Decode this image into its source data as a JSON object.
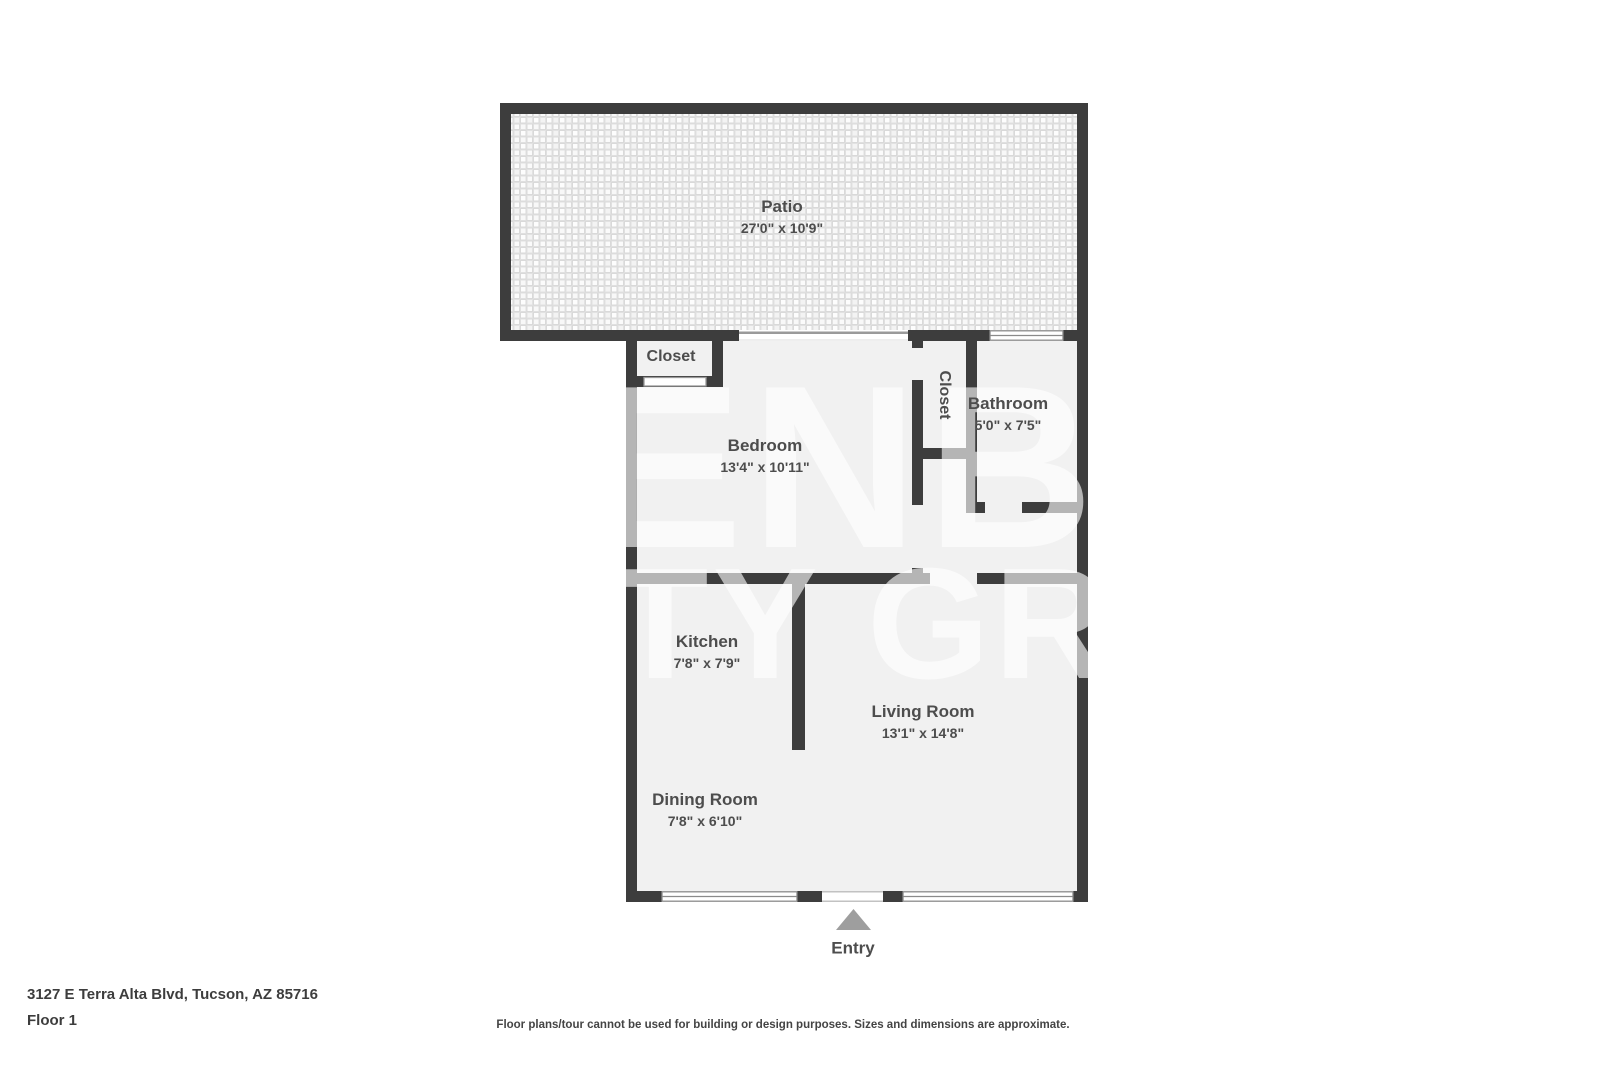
{
  "colors": {
    "wall": "#3d3d3d",
    "floor": "#f1f1f1",
    "label": "#4d4d4d",
    "entry-arrow": "#9e9e9e",
    "window-frame": "#8a8a8a"
  },
  "plan": {
    "rooms": {
      "patio": {
        "name": "Patio",
        "dims": "27'0\" x 10'9\""
      },
      "bedroom_closet": {
        "name": "Closet"
      },
      "bedroom": {
        "name": "Bedroom",
        "dims": "13'4\" x 10'11\""
      },
      "hall_closet": {
        "name": "Closet"
      },
      "bathroom": {
        "name": "Bathroom",
        "dims": "5'0\" x 7'5\""
      },
      "kitchen": {
        "name": "Kitchen",
        "dims": "7'8\" x 7'9\""
      },
      "living_room": {
        "name": "Living Room",
        "dims": "13'1\" x 14'8\""
      },
      "dining_room": {
        "name": "Dining Room",
        "dims": "7'8\" x 6'10\""
      }
    },
    "entry_label": "Entry",
    "watermark": {
      "line1": "ENBA",
      "line2": "TY GRO"
    }
  },
  "footer": {
    "address": "3127 E Terra Alta Blvd, Tucson, AZ 85716",
    "floor_label": "Floor 1",
    "disclaimer": "Floor plans/tour cannot be used for building or design purposes. Sizes and dimensions are approximate."
  }
}
